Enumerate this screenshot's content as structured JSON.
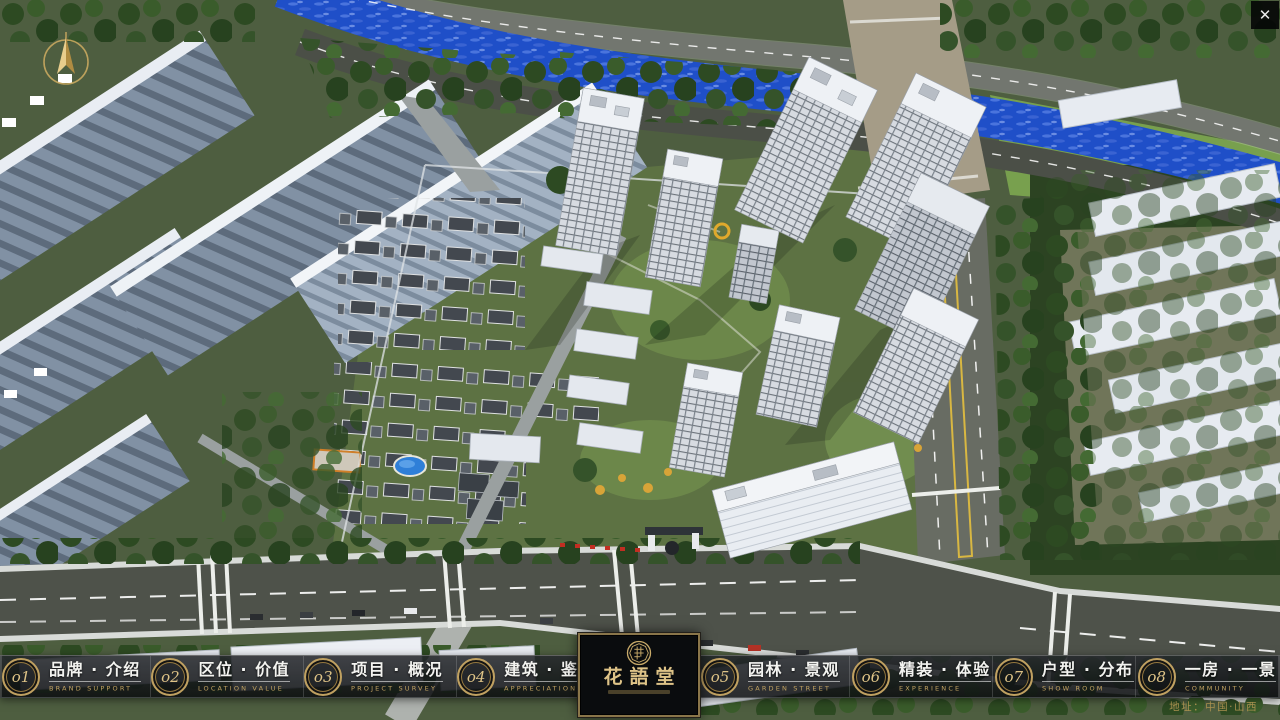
{
  "colors": {
    "gold": "#c0a161",
    "goldBright": "#dec387",
    "river": "#1f4fc8",
    "asphalt": "#4b4f47",
    "forest": "#223a1b"
  },
  "icons": {
    "close": "✕",
    "compass": "north-arrow",
    "logo_seal": "round-seal-emblem"
  },
  "nav": {
    "items": [
      {
        "num": "o1",
        "zh": "品牌 · 介绍",
        "en": "BRAND SUPPORT"
      },
      {
        "num": "o2",
        "zh": "区位 · 价值",
        "en": "LOCATION VALUE"
      },
      {
        "num": "o3",
        "zh": "项目 · 概况",
        "en": "PROJECT SURVEY"
      },
      {
        "num": "o4",
        "zh": "建筑 · 鉴赏",
        "en": "APPRECIATION"
      },
      {
        "num": "o5",
        "zh": "园林 · 景观",
        "en": "GARDEN STREET"
      },
      {
        "num": "o6",
        "zh": "精装 · 体验",
        "en": "EXPERIENCE"
      },
      {
        "num": "o7",
        "zh": "户型 · 分布",
        "en": "SHOW ROOM"
      },
      {
        "num": "o8",
        "zh": "一房 · 一景",
        "en": "COMMUNITY"
      }
    ]
  },
  "logo": {
    "title": "花語堂"
  },
  "footer": {
    "address": "地址：中国·山西"
  },
  "window": {
    "close_label": "✕"
  }
}
